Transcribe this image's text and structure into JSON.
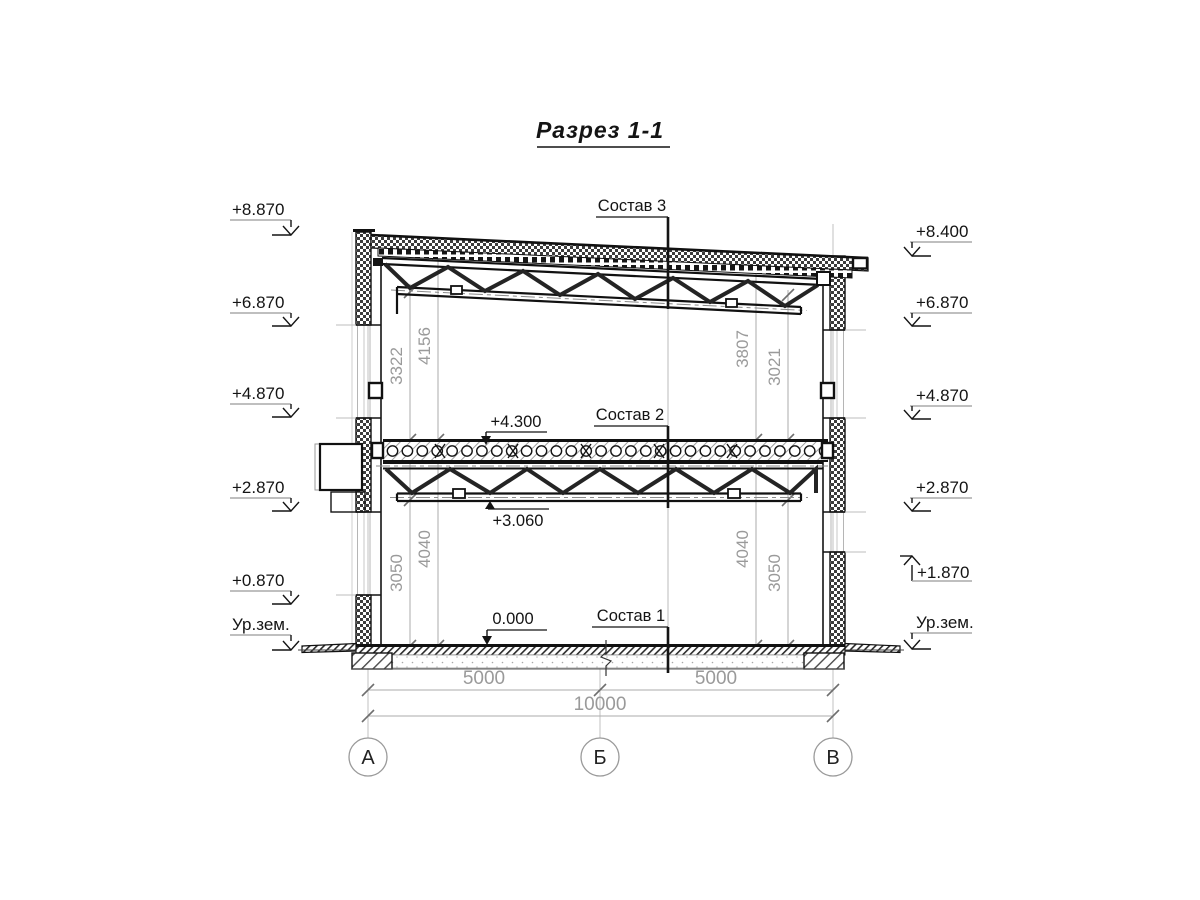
{
  "title": "Разрез 1-1",
  "callouts": {
    "sostav3": "Состав 3",
    "sostav2": "Состав 2",
    "sostav1": "Состав 1",
    "lvl_slab": "+4.300",
    "lvl_chord": "+3.060",
    "lvl_floor": "0.000"
  },
  "elevations_left": [
    {
      "label": "+8.870"
    },
    {
      "label": "+6.870"
    },
    {
      "label": "+4.870"
    },
    {
      "label": "+2.870"
    },
    {
      "label": "+0.870"
    },
    {
      "label": "Ур.зем."
    }
  ],
  "elevations_right": [
    {
      "label": "+8.400"
    },
    {
      "label": "+6.870"
    },
    {
      "label": "+4.870"
    },
    {
      "label": "+2.870"
    },
    {
      "label": "+1.870"
    },
    {
      "label": "Ур.зем."
    }
  ],
  "vertical_dims": {
    "upper_left_inner": "3322",
    "upper_left_outer": "4156",
    "upper_right_inner": "3807",
    "upper_right_outer": "3021",
    "lower_left_inner": "3050",
    "lower_left_outer": "4040",
    "lower_right_inner": "4040",
    "lower_right_outer": "3050"
  },
  "horizontal_dims": {
    "span_left": "5000",
    "span_right": "5000",
    "total": "10000"
  },
  "axes": [
    {
      "label": "А"
    },
    {
      "label": "Б"
    },
    {
      "label": "В"
    }
  ]
}
